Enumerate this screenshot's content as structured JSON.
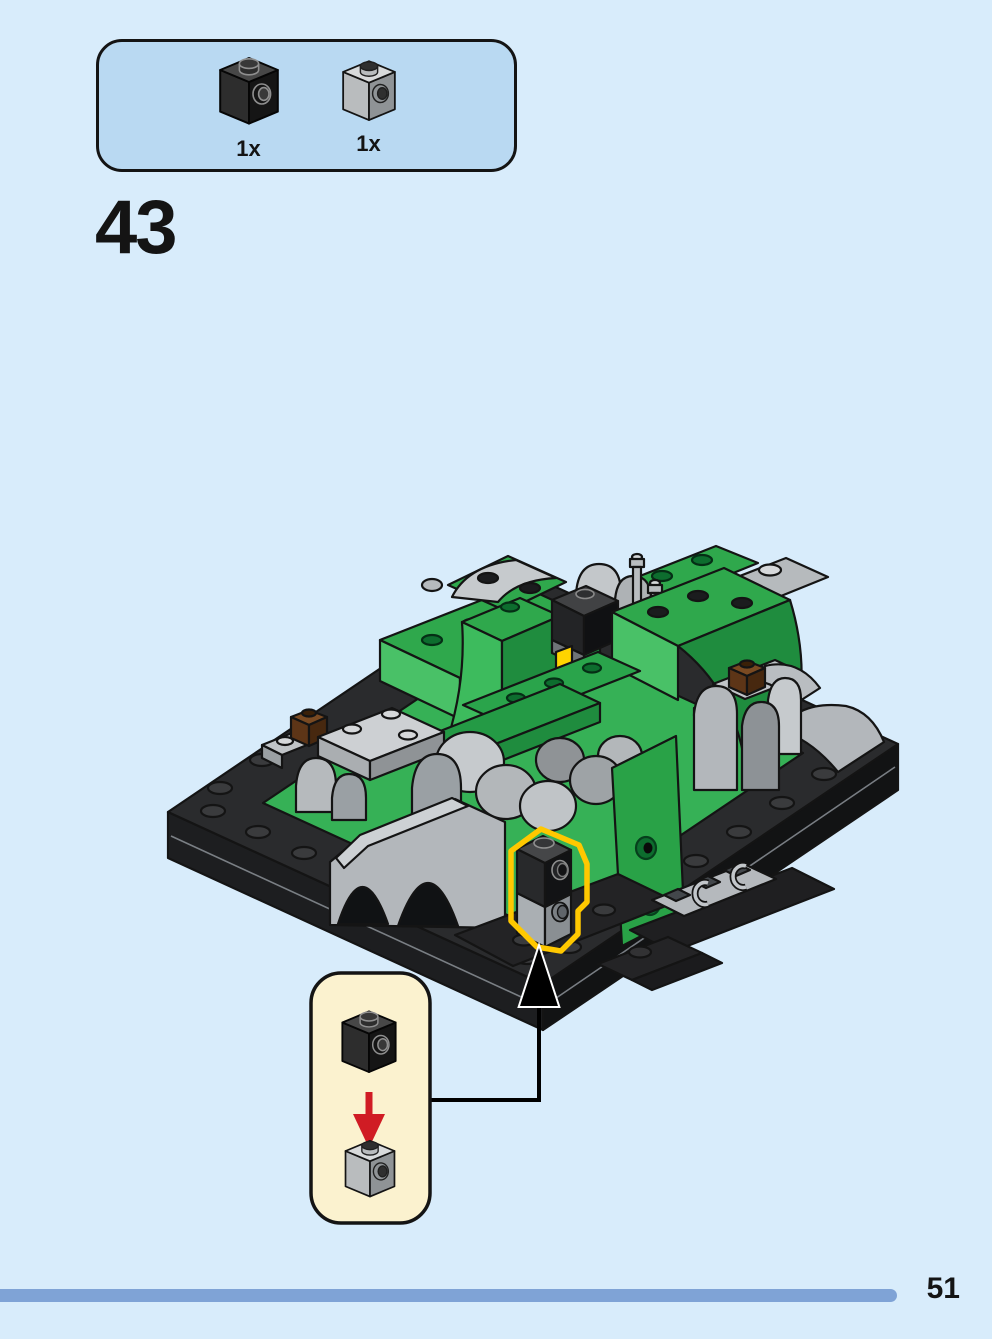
{
  "theme": {
    "page_bg": "#d8ecfb",
    "panel_blue": "#b9d9f2",
    "callout_cream": "#fbf2cf",
    "highlight_yellow": "#ffc800",
    "arrow_red": "#d01c24",
    "progress_blue": "#7fa3d6",
    "ink": "#141414"
  },
  "step": {
    "number": "43"
  },
  "parts_panel": {
    "parts": [
      {
        "id": "brick-1x1-side-stud-black",
        "color_name": "black",
        "count": "1x"
      },
      {
        "id": "brick-1x1-side-stud-light-gray",
        "color_name": "light-gray",
        "count": "1x"
      }
    ]
  },
  "assembly": {
    "model": "isometric-lego-scene-green-terrain-gray-rocks-on-black-baseplate",
    "highlight": "new-bricks-outlined-in-yellow",
    "callout": {
      "top_part": "brick-1x1-side-stud-black",
      "bottom_part": "brick-1x1-side-stud-light-gray",
      "action": "place-black-brick-onto-gray-brick"
    }
  },
  "footer": {
    "page_number": "51"
  }
}
